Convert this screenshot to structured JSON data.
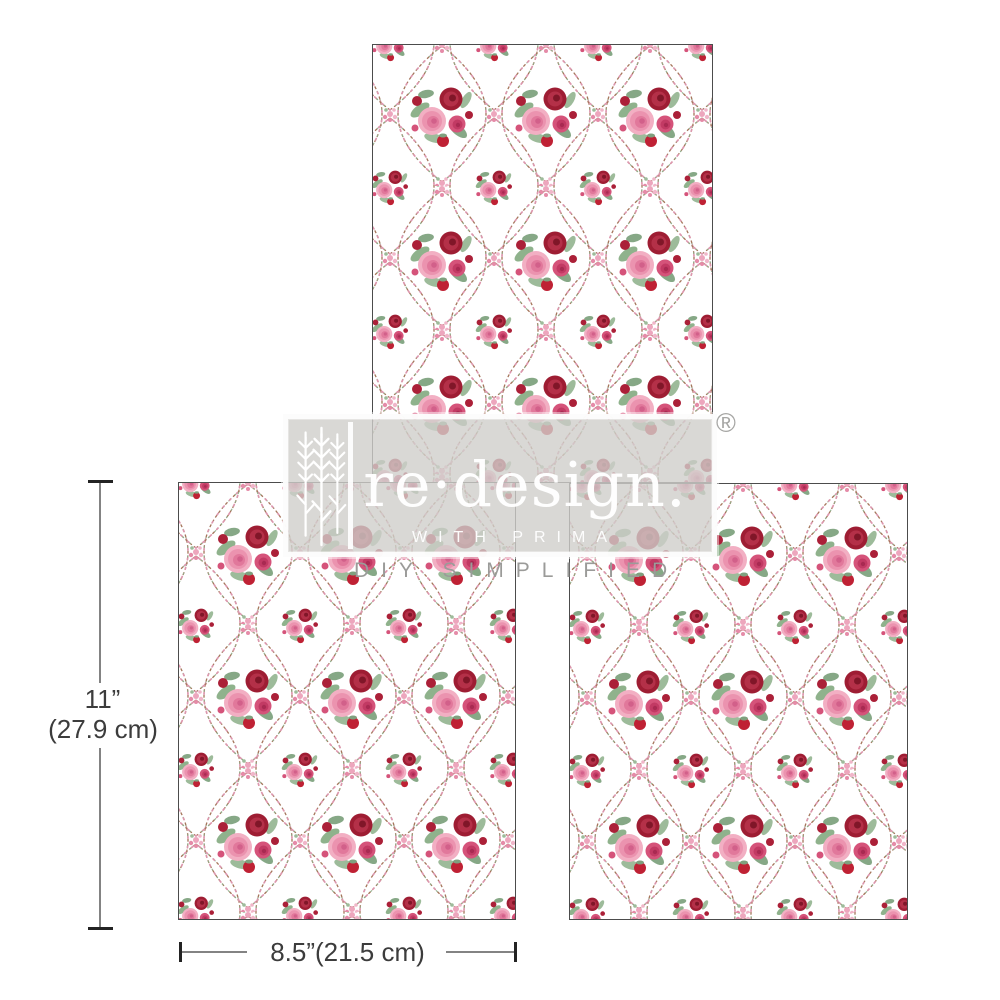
{
  "product_preview": {
    "sheets": [
      {
        "name": "sheet-top"
      },
      {
        "name": "sheet-bottom-left"
      },
      {
        "name": "sheet-bottom-right"
      }
    ],
    "pattern": {
      "description": "repeating ogee vine trellis with pink and red rose bouquets on white",
      "colors": {
        "background": "#ffffff",
        "rose_pink": "#f2afc3",
        "rose_magenta": "#d5537a",
        "rose_red": "#9e1d33",
        "bud_red": "#ab2038",
        "leaf_green": "#8fb28c",
        "vine_brown": "#a5755b",
        "vine_pink": "#dd97ae",
        "sheet_border": "#4c4c4c"
      }
    }
  },
  "watermark": {
    "brand": "re·design.",
    "registered_mark": "®",
    "subtitle": "WITH PRIMA",
    "tagline": "DIY SIMPLIFIED",
    "overlay_color": "#d0cecb"
  },
  "dimensions": {
    "height": {
      "inches": "11”",
      "metric": "(27.9 cm)"
    },
    "width": {
      "label": "8.5”(21.5 cm)"
    }
  }
}
